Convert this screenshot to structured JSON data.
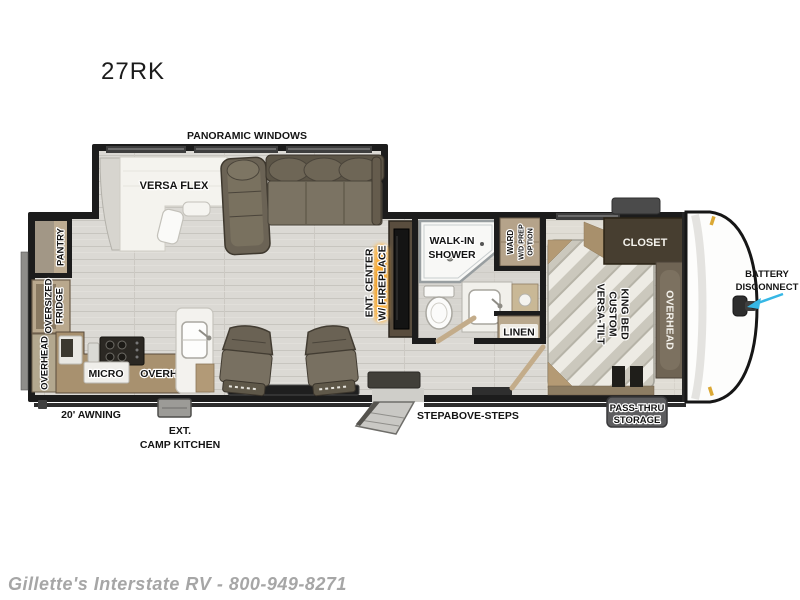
{
  "title": {
    "model": "27RK"
  },
  "footer": {
    "watermark": "Gillette's Interstate RV - 800-949-8271"
  },
  "labels": {
    "panoramic_windows": "PANORAMIC WINDOWS",
    "versa_flex": "VERSA FLEX",
    "pantry": "PANTRY",
    "oversized": "OVERSIZED",
    "fridge": "FRIDGE",
    "overhead_rear": "OVERHEAD",
    "micro": "MICRO",
    "overhead_kitchen": "OVERHEAD",
    "awning": "20' AWNING",
    "ext": "EXT.",
    "camp_kitchen": "CAMP KITCHEN",
    "ent_center": "ENT. CENTER",
    "w_fireplace": "W/ FIREPLACE",
    "walk_in": "WALK-IN",
    "shower": "SHOWER",
    "ward": "WARD",
    "wd_prep": "W/D PREP",
    "option": "OPTION",
    "linen": "LINEN",
    "stepabove": "STEPABOVE-STEPS",
    "versa_tilt": "VERSA-TILT",
    "custom": "CUSTOM",
    "king_bed": "KING BED",
    "closet": "CLOSET",
    "overhead_bedroom": "OVERHEAD",
    "pass_thru": "PASS-THRU",
    "storage": "STORAGE",
    "battery": "BATTERY",
    "disconnect": "DISCONNECT"
  },
  "colors": {
    "wall": "#1c1c1c",
    "floor": "#dbd9d4",
    "cabinet_tan": "#b5a38a",
    "counter_brown": "#a8916f",
    "sofa_brown": "#6e6557",
    "dark_wood": "#473e30",
    "overhead_wood": "#6f6454",
    "fireplace_orange": "#f59a12",
    "arrow_cyan": "#36b7e5"
  }
}
